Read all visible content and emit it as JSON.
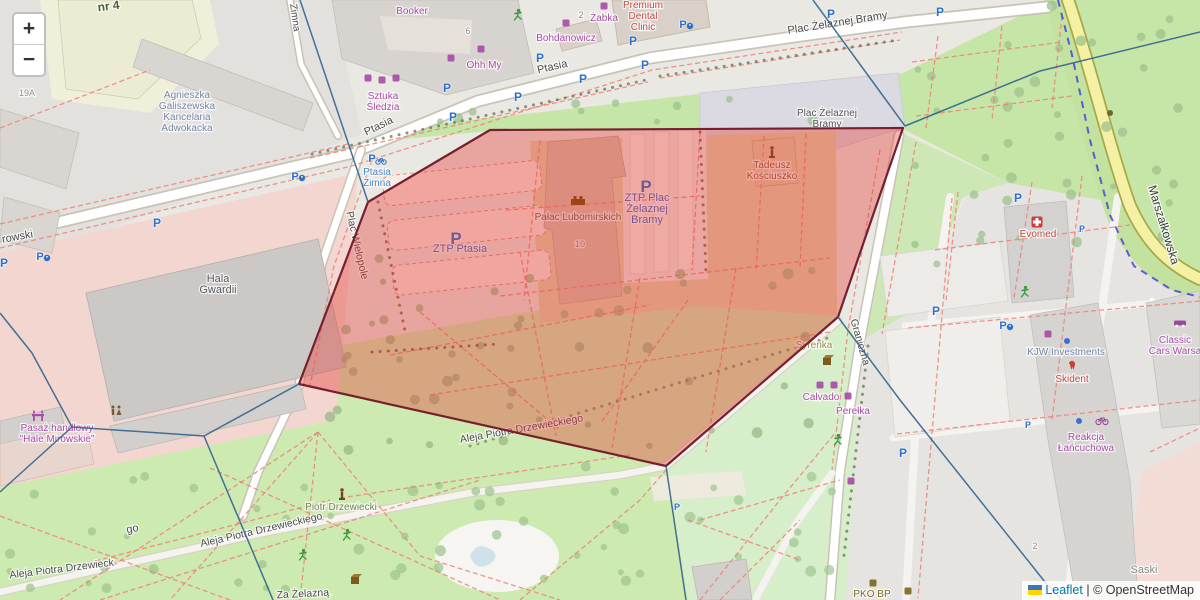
{
  "attribution": {
    "leaflet": "Leaflet",
    "separator": "|",
    "osm": "© OpenStreetMap"
  },
  "zoom_control": {
    "zoom_in": "+",
    "zoom_out": "−"
  },
  "map": {
    "overlay": {
      "polygon_points": "299,384 368,202 490,130 903,128 838,317 666,466",
      "fill": "rgba(228,55,49,0.38)",
      "stroke": "#76202e",
      "line_color": "#35668f",
      "voronoi_lines": [
        "300,0 368,202",
        "813,0 905,126",
        "905,126 1040,71 1200,32",
        "838,317 900,400 1045,582 1062,600",
        "666,466 686,600",
        "299,384 204,436",
        "204,436 72,427",
        "204,436 273,600",
        "72,427 32,353 0,313",
        "72,427 0,492"
      ]
    },
    "tram_line": {
      "points": "1058,0 1072,55 1090,140 1110,215 1134,266 1172,290 1200,297",
      "color": "#3c3cd9"
    },
    "street_labels": [
      {
        "t": "Ptasia",
        "x": 553,
        "y": 70,
        "r": -13,
        "s": 11
      },
      {
        "t": "Ptasia",
        "x": 380,
        "y": 129,
        "r": -26,
        "s": 11
      },
      {
        "t": "Plac Żelaznej Bramy",
        "x": 838,
        "y": 26,
        "r": -9,
        "s": 11
      },
      {
        "t": "Zimna",
        "x": 292,
        "y": 18,
        "r": 82,
        "s": 10
      },
      {
        "t": "Marszałkowska",
        "x": 1160,
        "y": 226,
        "r": 73,
        "s": 12,
        "c": "#3c3c3c"
      },
      {
        "t": "Plac Wielopole",
        "x": 354,
        "y": 246,
        "r": 77,
        "s": 10.5
      },
      {
        "t": "Graniczna",
        "x": 857,
        "y": 343,
        "r": 74,
        "s": 10.5
      },
      {
        "t": "Aleja Piotra Drzewieckiego",
        "x": 262,
        "y": 533,
        "r": -13,
        "s": 10.5
      },
      {
        "t": "Aleja Piotra Drzewieckiego",
        "x": 522,
        "y": 432,
        "r": -10,
        "s": 10.5
      },
      {
        "t": "Aleja Piotra Drzewieck",
        "x": 62,
        "y": 572,
        "r": -7,
        "s": 10.5
      },
      {
        "t": "rowski",
        "x": 18,
        "y": 240,
        "r": -10,
        "s": 11
      },
      {
        "t": "Za Żelazną",
        "x": 303,
        "y": 597,
        "r": -3,
        "s": 10.5
      },
      {
        "t": "go",
        "x": 133,
        "y": 532,
        "r": -10,
        "s": 11
      },
      {
        "t": "Saski",
        "x": 1144,
        "y": 573,
        "r": 0,
        "s": 11,
        "c": "#8a8a8a"
      },
      {
        "t": "nr 4",
        "x": 109,
        "y": 10,
        "r": -7,
        "s": 12,
        "c": "#4e5d33",
        "b": true
      },
      {
        "t": "19A",
        "x": 27,
        "y": 96,
        "r": 0,
        "s": 9,
        "c": "#909090"
      },
      {
        "t": "10",
        "x": 580,
        "y": 247,
        "r": 0,
        "s": 9,
        "c": "#8a8a8a"
      },
      {
        "t": "6",
        "x": 468,
        "y": 34,
        "r": 0,
        "s": 9,
        "c": "#8a8a8a"
      },
      {
        "t": "2",
        "x": 581,
        "y": 18,
        "r": 0,
        "s": 9,
        "c": "#8a8a8a"
      },
      {
        "t": "2",
        "x": 1035,
        "y": 549,
        "r": 0,
        "s": 9,
        "c": "#8a8a8a"
      }
    ],
    "poi_labels": [
      {
        "lines": [
          "Agnieszka",
          "Galiszewska",
          "Kancelaria",
          "Adwokacka"
        ],
        "x": 187,
        "y": 98,
        "c": "#7585a8"
      },
      {
        "lines": [
          "Booker"
        ],
        "x": 412,
        "y": 14,
        "c": "#a84ca8"
      },
      {
        "lines": [
          "Ohh My"
        ],
        "x": 484,
        "y": 68,
        "c": "#a84ca8"
      },
      {
        "lines": [
          "Sztuka",
          "Śledzia"
        ],
        "x": 383,
        "y": 99,
        "c": "#a84ca8"
      },
      {
        "lines": [
          "Bohdanowicz"
        ],
        "x": 566,
        "y": 41,
        "c": "#a84ca8"
      },
      {
        "lines": [
          "Żabka"
        ],
        "x": 604,
        "y": 21,
        "c": "#a84ca8"
      },
      {
        "lines": [
          "Premium",
          "Dental",
          "Clinic"
        ],
        "x": 643,
        "y": 8,
        "c": "#c04a42"
      },
      {
        "lines": [
          "Ptasia",
          "Zimna"
        ],
        "x": 377,
        "y": 175,
        "c": "#4a86c8"
      },
      {
        "lines": [
          "Pałac Lubomirskich"
        ],
        "x": 578,
        "y": 220,
        "c": "#5f5a50"
      },
      {
        "lines": [
          "ZTP Ptasia"
        ],
        "x": 460,
        "y": 252,
        "c": "#3468c8",
        "s": 11
      },
      {
        "lines": [
          "ZTP Plac",
          "Żelaznej",
          "Bramy"
        ],
        "x": 647,
        "y": 201,
        "c": "#3468c8",
        "s": 11
      },
      {
        "lines": [
          "Tadeusz",
          "Kościuszko"
        ],
        "x": 772,
        "y": 168,
        "c": "#8a5a28"
      },
      {
        "lines": [
          "Evomed"
        ],
        "x": 1038,
        "y": 237,
        "c": "#c04a42"
      },
      {
        "lines": [
          "Syrenka"
        ],
        "x": 814,
        "y": 348,
        "c": "#9a8f3a"
      },
      {
        "lines": [
          "Calvado"
        ],
        "x": 821,
        "y": 400,
        "c": "#a84ca8"
      },
      {
        "lines": [
          "Perełka"
        ],
        "x": 853,
        "y": 414,
        "c": "#a84ca8"
      },
      {
        "lines": [
          "KJW Investments"
        ],
        "x": 1066,
        "y": 355,
        "c": "#7585a8"
      },
      {
        "lines": [
          "Skident"
        ],
        "x": 1072,
        "y": 382,
        "c": "#c04a42"
      },
      {
        "lines": [
          "Reakcja",
          "Łańcuchowa"
        ],
        "x": 1086,
        "y": 440,
        "c": "#a84ca8"
      },
      {
        "lines": [
          "Classic",
          "Cars Warsa"
        ],
        "x": 1175,
        "y": 343,
        "c": "#a84ca8"
      },
      {
        "lines": [
          "Pasaż handlowy",
          "\"Hale Mirowskie\""
        ],
        "x": 57,
        "y": 431,
        "c": "#a84ca8"
      },
      {
        "lines": [
          "PKO BP"
        ],
        "x": 872,
        "y": 597,
        "c": "#7a6a20"
      },
      {
        "lines": [
          "Hala",
          "Gwardii"
        ],
        "x": 218,
        "y": 282,
        "c": "#5a5a5a",
        "s": 11
      },
      {
        "lines": [
          "Plac Żelaznej",
          "Bramy"
        ],
        "x": 827,
        "y": 116,
        "c": "#555555"
      },
      {
        "lines": [
          "Piotr Drzewiecki"
        ],
        "x": 341,
        "y": 510,
        "c": "#718355"
      }
    ],
    "icons": [
      {
        "t": "plarge",
        "x": 456,
        "y": 238
      },
      {
        "t": "plarge",
        "x": 646,
        "y": 186
      },
      {
        "t": "p",
        "x": 447,
        "y": 88
      },
      {
        "t": "p",
        "x": 518,
        "y": 97
      },
      {
        "t": "p",
        "x": 453,
        "y": 117
      },
      {
        "t": "p",
        "x": 540,
        "y": 58
      },
      {
        "t": "p",
        "x": 583,
        "y": 79
      },
      {
        "t": "p",
        "x": 633,
        "y": 41
      },
      {
        "t": "p",
        "x": 645,
        "y": 65
      },
      {
        "t": "p",
        "x": 831,
        "y": 14
      },
      {
        "t": "p",
        "x": 940,
        "y": 12
      },
      {
        "t": "p",
        "x": 157,
        "y": 223
      },
      {
        "t": "p",
        "x": 4,
        "y": 263
      },
      {
        "t": "p",
        "x": 1018,
        "y": 198
      },
      {
        "t": "p",
        "x": 936,
        "y": 311
      },
      {
        "t": "p",
        "x": 903,
        "y": 453
      },
      {
        "t": "p",
        "x": 1028,
        "y": 424,
        "s": 9
      },
      {
        "t": "p",
        "x": 1082,
        "y": 228,
        "s": 9
      },
      {
        "t": "p",
        "x": 677,
        "y": 506,
        "s": 9
      },
      {
        "t": "pacc",
        "x": 295,
        "y": 176
      },
      {
        "t": "pacc",
        "x": 40,
        "y": 256
      },
      {
        "t": "pacc",
        "x": 683,
        "y": 24
      },
      {
        "t": "pacc",
        "x": 1003,
        "y": 325
      },
      {
        "t": "pbike",
        "x": 372,
        "y": 158
      },
      {
        "t": "castle",
        "x": 578,
        "y": 200
      },
      {
        "t": "statue",
        "x": 772,
        "y": 152
      },
      {
        "t": "statue",
        "x": 342,
        "y": 494
      },
      {
        "t": "cross",
        "x": 1037,
        "y": 222
      },
      {
        "t": "cube",
        "x": 827,
        "y": 359
      },
      {
        "t": "cube",
        "x": 355,
        "y": 578
      },
      {
        "t": "wc",
        "x": 116,
        "y": 411
      },
      {
        "t": "shopfront",
        "x": 38,
        "y": 416
      },
      {
        "t": "tooth",
        "x": 1072,
        "y": 366
      },
      {
        "t": "car",
        "x": 1180,
        "y": 324
      },
      {
        "t": "bike",
        "x": 1102,
        "y": 421
      },
      {
        "t": "runner",
        "x": 347,
        "y": 535
      },
      {
        "t": "runner",
        "x": 303,
        "y": 555
      },
      {
        "t": "runner",
        "x": 518,
        "y": 15
      },
      {
        "t": "runner",
        "x": 1025,
        "y": 292
      },
      {
        "t": "runner",
        "x": 838,
        "y": 440
      },
      {
        "t": "shop",
        "x": 368,
        "y": 78
      },
      {
        "t": "shop",
        "x": 382,
        "y": 80
      },
      {
        "t": "shop",
        "x": 396,
        "y": 78
      },
      {
        "t": "shop",
        "x": 451,
        "y": 58
      },
      {
        "t": "shop",
        "x": 481,
        "y": 49
      },
      {
        "t": "shop",
        "x": 604,
        "y": 6
      },
      {
        "t": "shop",
        "x": 820,
        "y": 385
      },
      {
        "t": "shop",
        "x": 834,
        "y": 385
      },
      {
        "t": "shop",
        "x": 848,
        "y": 396
      },
      {
        "t": "shop",
        "x": 1048,
        "y": 334
      },
      {
        "t": "shop",
        "x": 851,
        "y": 481
      },
      {
        "t": "shop",
        "x": 566,
        "y": 23
      },
      {
        "t": "shop",
        "x": 873,
        "y": 583,
        "c": "#7a6a20"
      },
      {
        "t": "shop",
        "x": 908,
        "y": 591,
        "c": "#7a6a20"
      },
      {
        "t": "dot",
        "x": 1067,
        "y": 341,
        "c": "#3b6fd4"
      },
      {
        "t": "dot",
        "x": 1079,
        "y": 421,
        "c": "#3b6fd4"
      },
      {
        "t": "dot",
        "x": 1110,
        "y": 113,
        "c": "#6a6a30"
      }
    ],
    "tree_regions": [
      {
        "x": 915,
        "y": 5,
        "w": 280,
        "h": 260,
        "n": 40,
        "c": "#9dc28c",
        "seed": 7
      },
      {
        "x": 10,
        "y": 465,
        "w": 640,
        "h": 125,
        "n": 45,
        "c": "#9fc58f",
        "seed": 13
      },
      {
        "x": 330,
        "y": 258,
        "w": 500,
        "h": 195,
        "n": 50,
        "c": "#98b887",
        "seed": 29
      },
      {
        "x": 690,
        "y": 470,
        "w": 150,
        "h": 120,
        "n": 12,
        "c": "#a3c893",
        "seed": 41
      },
      {
        "x": 440,
        "y": 98,
        "w": 440,
        "h": 24,
        "n": 10,
        "c": "#9dc28c",
        "seed": 53
      }
    ]
  }
}
